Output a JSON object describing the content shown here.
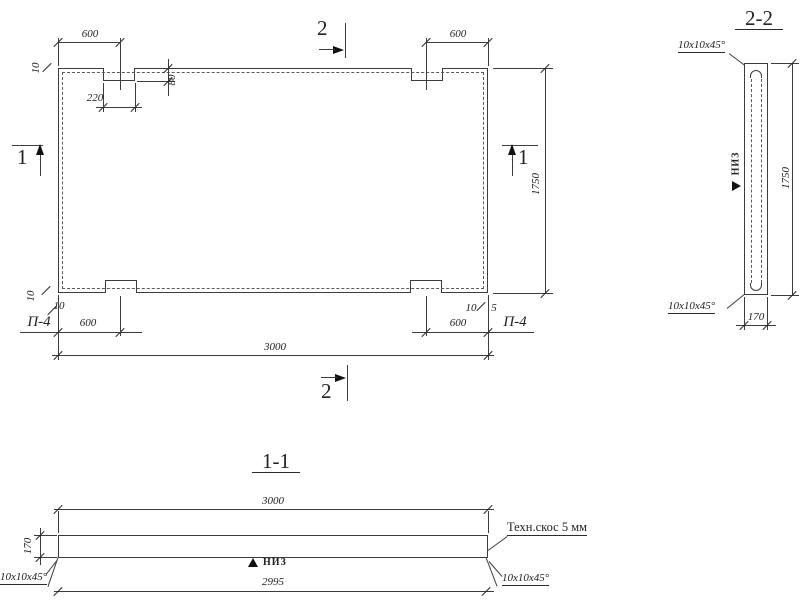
{
  "style": {
    "ink": "#3c3c3c",
    "background": "#ffffff"
  },
  "plan": {
    "dim_600_top_left": "600",
    "dim_600_top_right": "600",
    "dim_600_bottom_left": "600",
    "dim_600_bottom_right": "600",
    "dim_220": "220",
    "dim_80": "80",
    "dim_10_top_left": "10",
    "dim_10_bottom_left_vert": "10",
    "dim_10_bottom_left": "10",
    "dim_10_bottom_right": "10",
    "dim_5_bottom_right": "5",
    "dim_width_3000": "3000",
    "dim_height_1750": "1750",
    "label_p4_left": "П-4",
    "label_p4_right": "П-4",
    "cut_mark_1_left": "1",
    "cut_mark_1_right": "1",
    "cut_mark_2_top": "2",
    "cut_mark_2_bottom": "2"
  },
  "section_2_2": {
    "title": "2-2",
    "chamfer_top": "10x10x45°",
    "chamfer_bottom": "10x10x45°",
    "label_niz": "НИЗ",
    "dim_width_170": "170",
    "dim_height_1750": "1750"
  },
  "section_1_1": {
    "title": "1-1",
    "dim_width_3000": "3000",
    "dim_thickness_170": "170",
    "label_niz": "НИЗ",
    "dim_width_2995": "2995",
    "chamfer_left": "10x10x45°",
    "chamfer_right": "10x10x45°",
    "note_tech_bevel": "Техн.скос 5 мм"
  }
}
